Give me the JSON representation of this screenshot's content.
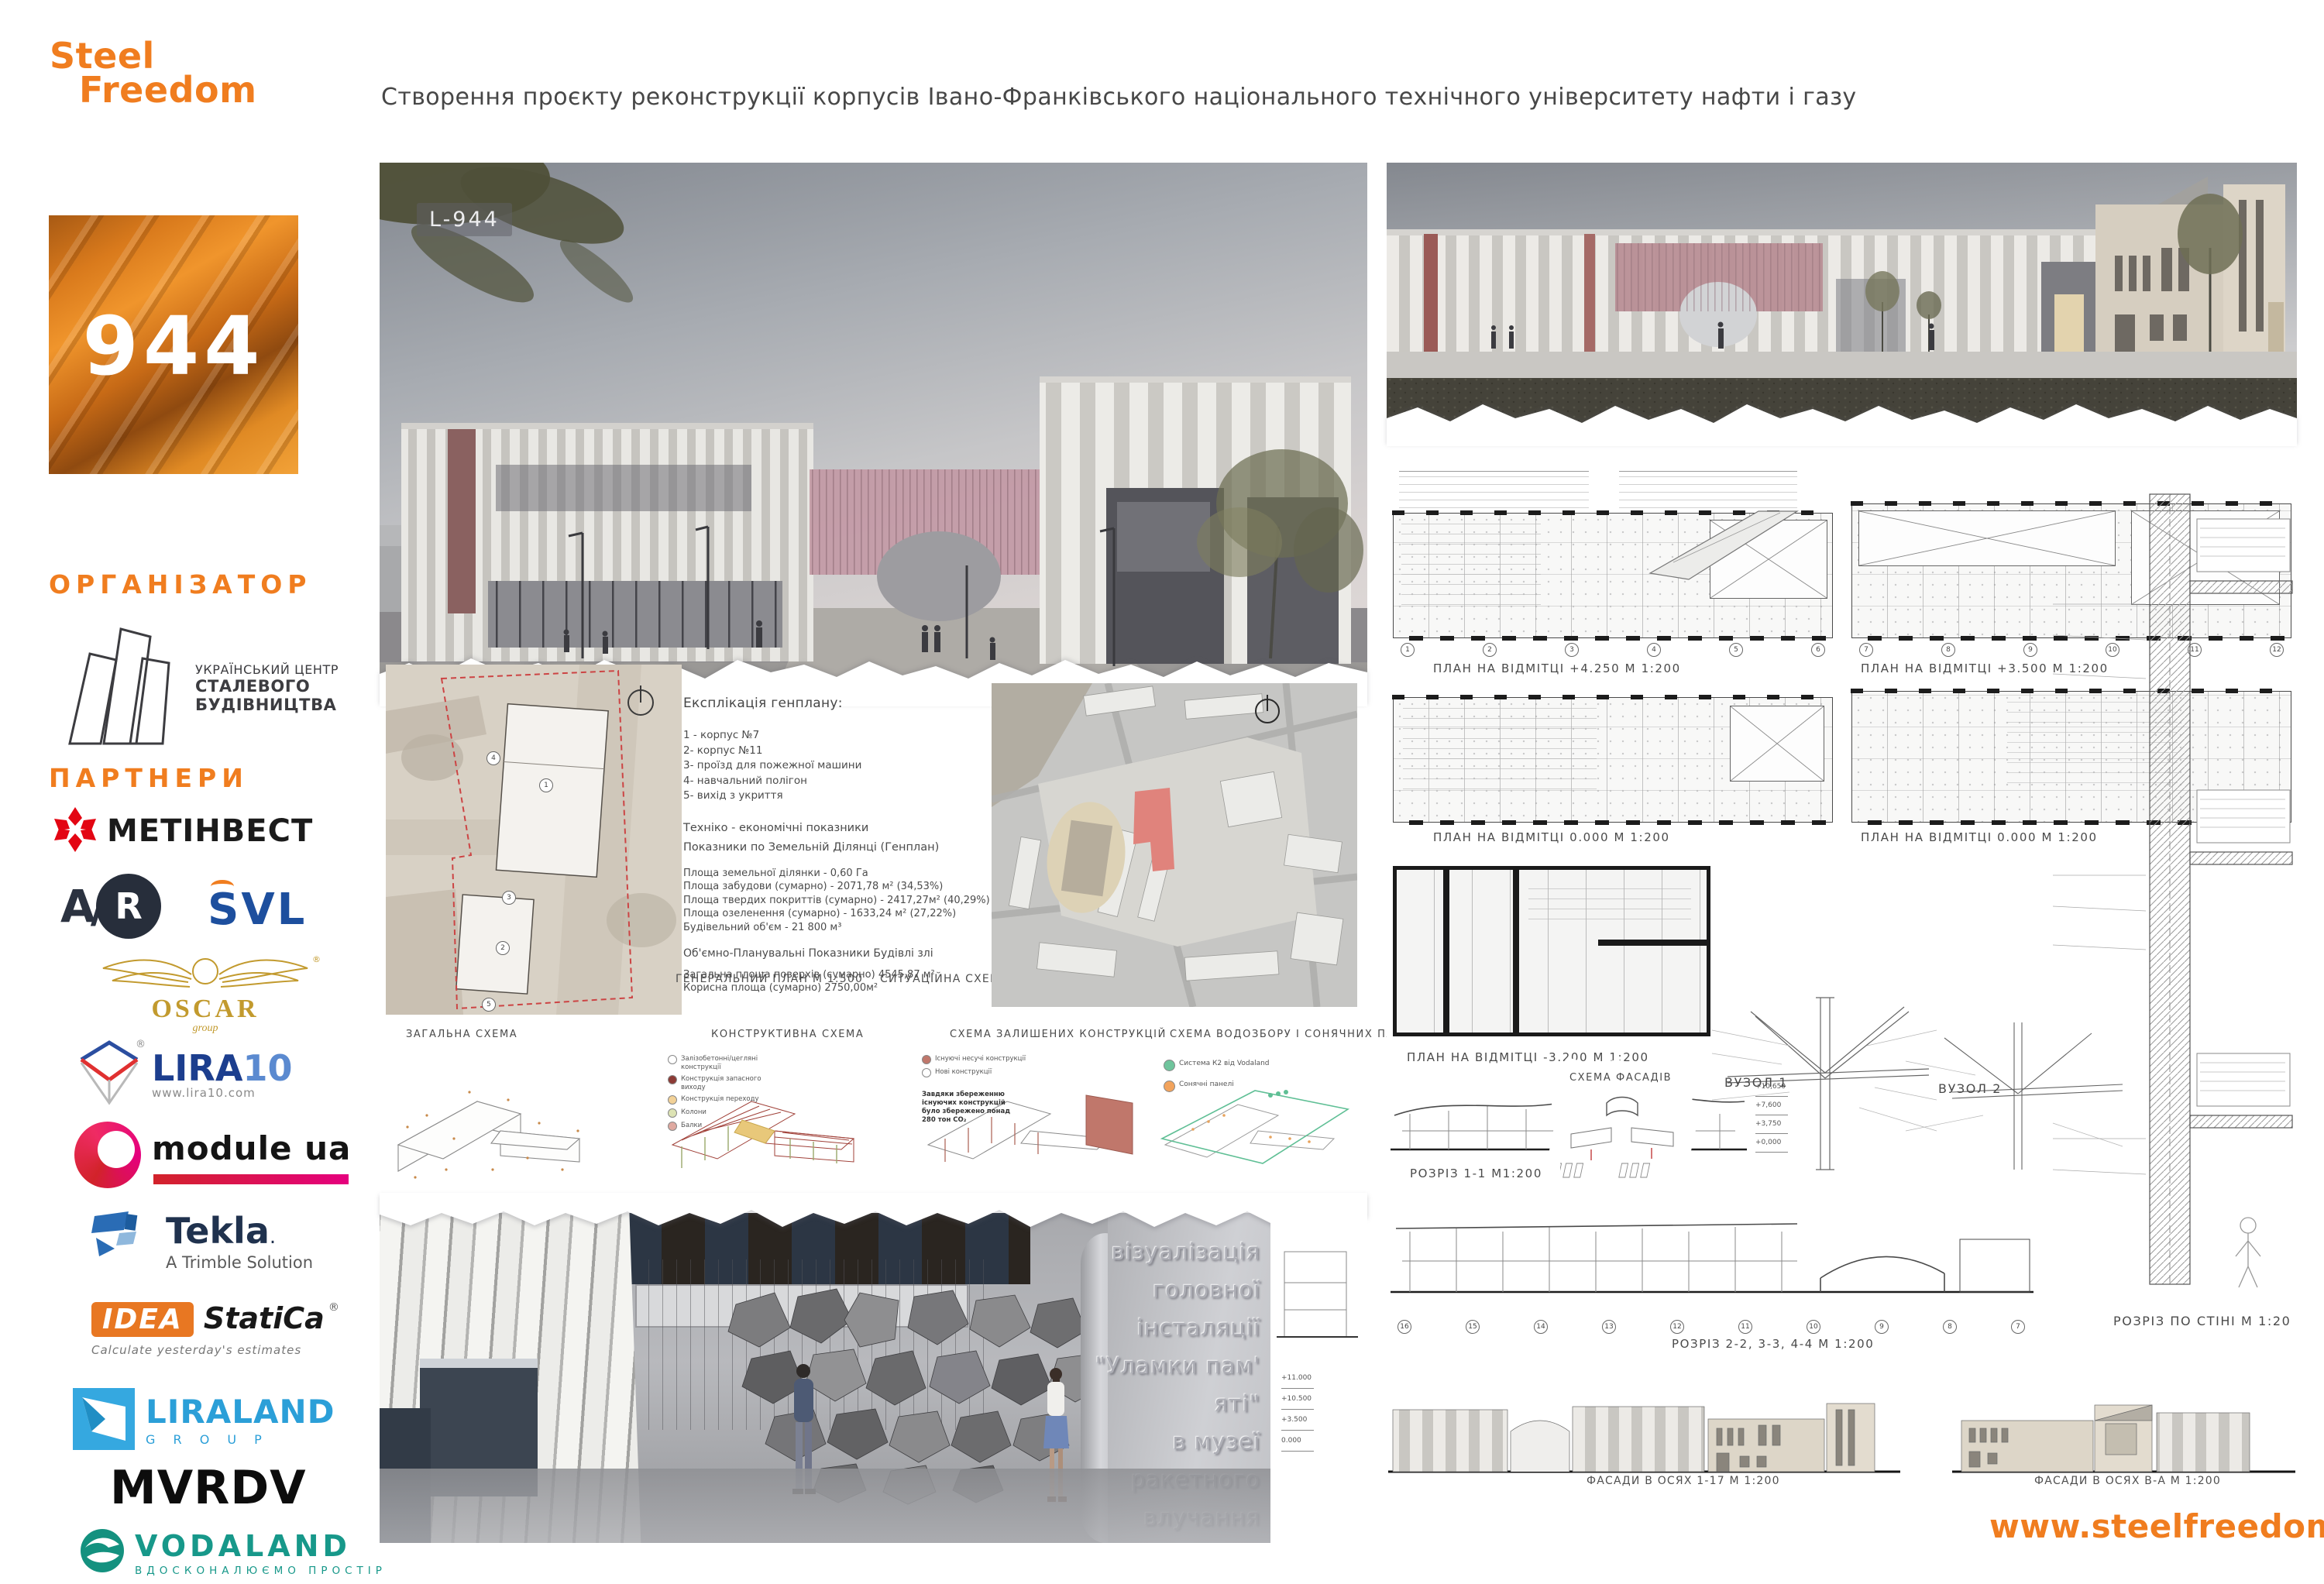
{
  "brand": {
    "logo_line1": "Steel",
    "logo_line2": "Freedom",
    "entry_number": "944",
    "render_tag": "L-944",
    "website": "www.steelfreedom.ua",
    "accent_color": "#F07D1F"
  },
  "header": {
    "title": "Створення проєкту реконструкції корпусів Івано-Франківського національного технічного університету нафти і газу"
  },
  "organizer": {
    "heading": "ОРГАНІЗАТОР",
    "name_line1": "УКРАЇНСЬКИЙ ЦЕНТР",
    "name_line2": "СТАЛЕВОГО",
    "name_line3": "БУДІВНИЦТВА"
  },
  "partners": {
    "heading": "ПАРТНЕРИ",
    "metinvest": "МЕТІНВЕСТ",
    "avr_a": "A",
    "avr_slash": "/",
    "avr_r": "R",
    "svl": "SVL",
    "oscar": "OSCAR",
    "oscar_sub": "group",
    "oscar_reg": "®",
    "lira": "LIRA",
    "lira_num": "10",
    "lira_reg": "®",
    "lira_site": "www.lira10.com",
    "module": "module ua",
    "tekla": "Tekla",
    "tekla_dot": ".",
    "tekla_sub": "A Trimble Solution",
    "idea": "IDEA",
    "idea2": "StatiCa",
    "idea_reg": "®",
    "idea_sub": "Calculate yesterday's estimates",
    "liraland": "LIRALAND",
    "liraland_sub": "G R O U P",
    "mvrdv": "MVRDV",
    "vodaland": "VODALAND",
    "vodaland_sub": "ВДОСКОНАЛЮЄМО ПРОСТІР"
  },
  "board_left": {
    "explication": {
      "heading": "Експлікація генплану:",
      "items": [
        "1 - корпус №7",
        "2- корпус №11",
        "3- проїзд для пожежної машини",
        "4- навчальний полігон",
        "5- вихід з укриття"
      ],
      "tech_heading": "Техніко - економічні показники",
      "tech_sub": "Показники по Земельній Ділянці (Генплан)",
      "metrics": [
        "Площа земельної ділянки - 0,60 Га",
        "Площа забудови (сумарно) - 2071,78 м² (34,53%)",
        "Площа твердих покриттів (сумарно) - 2417,27м² (40,29%)",
        "Площа озеленення (сумарно) - 1633,24 м² (27,22%)",
        "Будівельний об'єм - 21 800 м³"
      ],
      "volume_heading": "Об'ємно-Планувальні Показники Будівлі злі",
      "volume_metrics": [
        "Загальна площа поверхів (сумарно) 4545,87 м²",
        "Корисна площа (сумарно) 2750,00м²"
      ]
    },
    "genplan_label": "ГЕНЕРАЛЬНИЙ ПЛАН  М 1:500",
    "situation_label": "СИТУАЦІЙНА СХЕМА  М 1:2000",
    "site_numbers": [
      "1",
      "2",
      "3",
      "4",
      "5"
    ],
    "scheme_titles": [
      "ЗАГАЛЬНА СХЕМА",
      "КОНСТРУКТИВНА СХЕМА",
      "СХЕМА ЗАЛИШЕНИХ КОНСТРУКЦІЙ",
      "СХЕМА ВОДОЗБОРУ І СОНЯЧНИХ ПАНЕЛЕЙ"
    ],
    "legend_constructive": [
      {
        "label": "Залізобетонні/цегляні конструкції",
        "color": "#ffffff"
      },
      {
        "label": "Конструкція запасного виходу",
        "color": "#8c3b35"
      },
      {
        "label": "Конструкція переходу",
        "color": "#f2d197"
      },
      {
        "label": "Колони",
        "color": "#dde3b4"
      },
      {
        "label": "Балки",
        "color": "#dfa9a0"
      }
    ],
    "legend_remaining": [
      {
        "label": "Існуючі несучі конструкції",
        "color": "#c0776b"
      },
      {
        "label": "Нові конструкції",
        "color": "#ffffff"
      }
    ],
    "remaining_note": "Завдяки збереженню існуючих конструкцій було збережено понад 280 тон CO₂",
    "legend_water": [
      {
        "label": "Система К2 від Vodaland",
        "color": "#6fc49c"
      },
      {
        "label": "Сонячні панелі",
        "color": "#f2a35c"
      }
    ],
    "installation_caption": [
      "візуалізація",
      "головної",
      "інсталяції",
      "\"Уламки пам' яті\"",
      "в музеї",
      "ракетного влучання"
    ],
    "side_levels": [
      "+11.000",
      "+10.500",
      "+3.500",
      "0.000"
    ]
  },
  "board_right": {
    "plan_row1_left": "ПЛАН НА ВІДМІТЦІ  +4.250  М 1:200",
    "plan_row1_right": "ПЛАН НА ВІДМІТЦІ  +3.500  М 1:200",
    "plan_row2_left": "ПЛАН НА ВІДМІТЦІ 0.000  М 1:200",
    "plan_row2_right": "ПЛАН НА ВІДМІТЦІ 0.000  М 1:200",
    "plan_row3": "ПЛАН НА ВІДМІТЦІ -3.200  М 1:200",
    "section11": "РОЗРІЗ 1-1  М1:200",
    "scheme_facades": "СХЕМА ФАСАДІВ",
    "node1": "ВУЗОЛ 1",
    "node2": "ВУЗОЛ 2",
    "section234": "РОЗРІЗ 2-2, 3-3, 4-4  М 1:200",
    "wall_section": "РОЗРІЗ ПО СТІНІ М 1:20",
    "facade1": "ФАСАДИ В ОСЯХ 1-17  М 1:200",
    "facade2": "ФАСАДИ В ОСЯХ В-А  М 1:200",
    "axes_left": [
      "1",
      "2",
      "3",
      "4",
      "5",
      "6"
    ],
    "axes_right": [
      "7",
      "8",
      "9",
      "10",
      "11",
      "12"
    ],
    "axes_section": [
      "16",
      "15",
      "14",
      "13",
      "12",
      "11",
      "10",
      "9",
      "8",
      "7"
    ],
    "levels": [
      "+10,650",
      "+7,600",
      "+3,750",
      "+0,000"
    ]
  }
}
